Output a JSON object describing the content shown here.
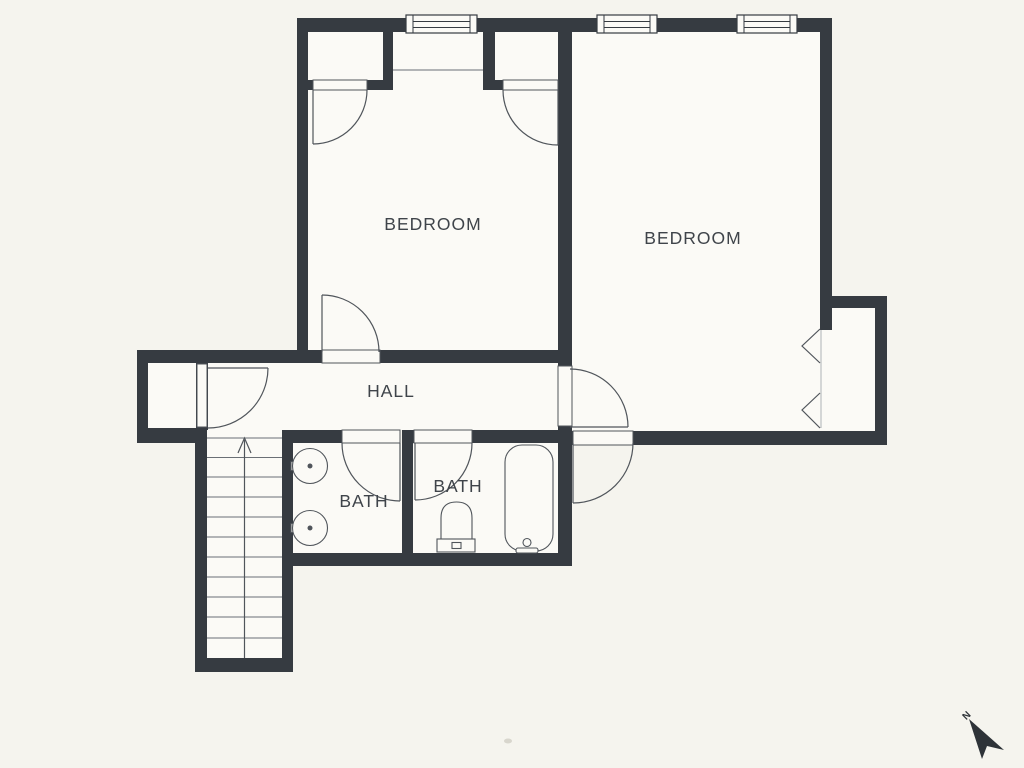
{
  "page": {
    "background_color": "#f5f4ee"
  },
  "floorplan": {
    "wall_color": "#363b41",
    "floor_color": "#fbfaf6",
    "line_color": "#50555b",
    "label_color": "#3f444a",
    "rooms": {
      "bedroom_left": {
        "label": "BEDROOM"
      },
      "bedroom_right": {
        "label": "BEDROOM"
      },
      "hall": {
        "label": "HALL"
      },
      "bath_left": {
        "label": "BATH"
      },
      "bath_right": {
        "label": "BATH"
      }
    },
    "compass": {
      "label": "N"
    }
  }
}
